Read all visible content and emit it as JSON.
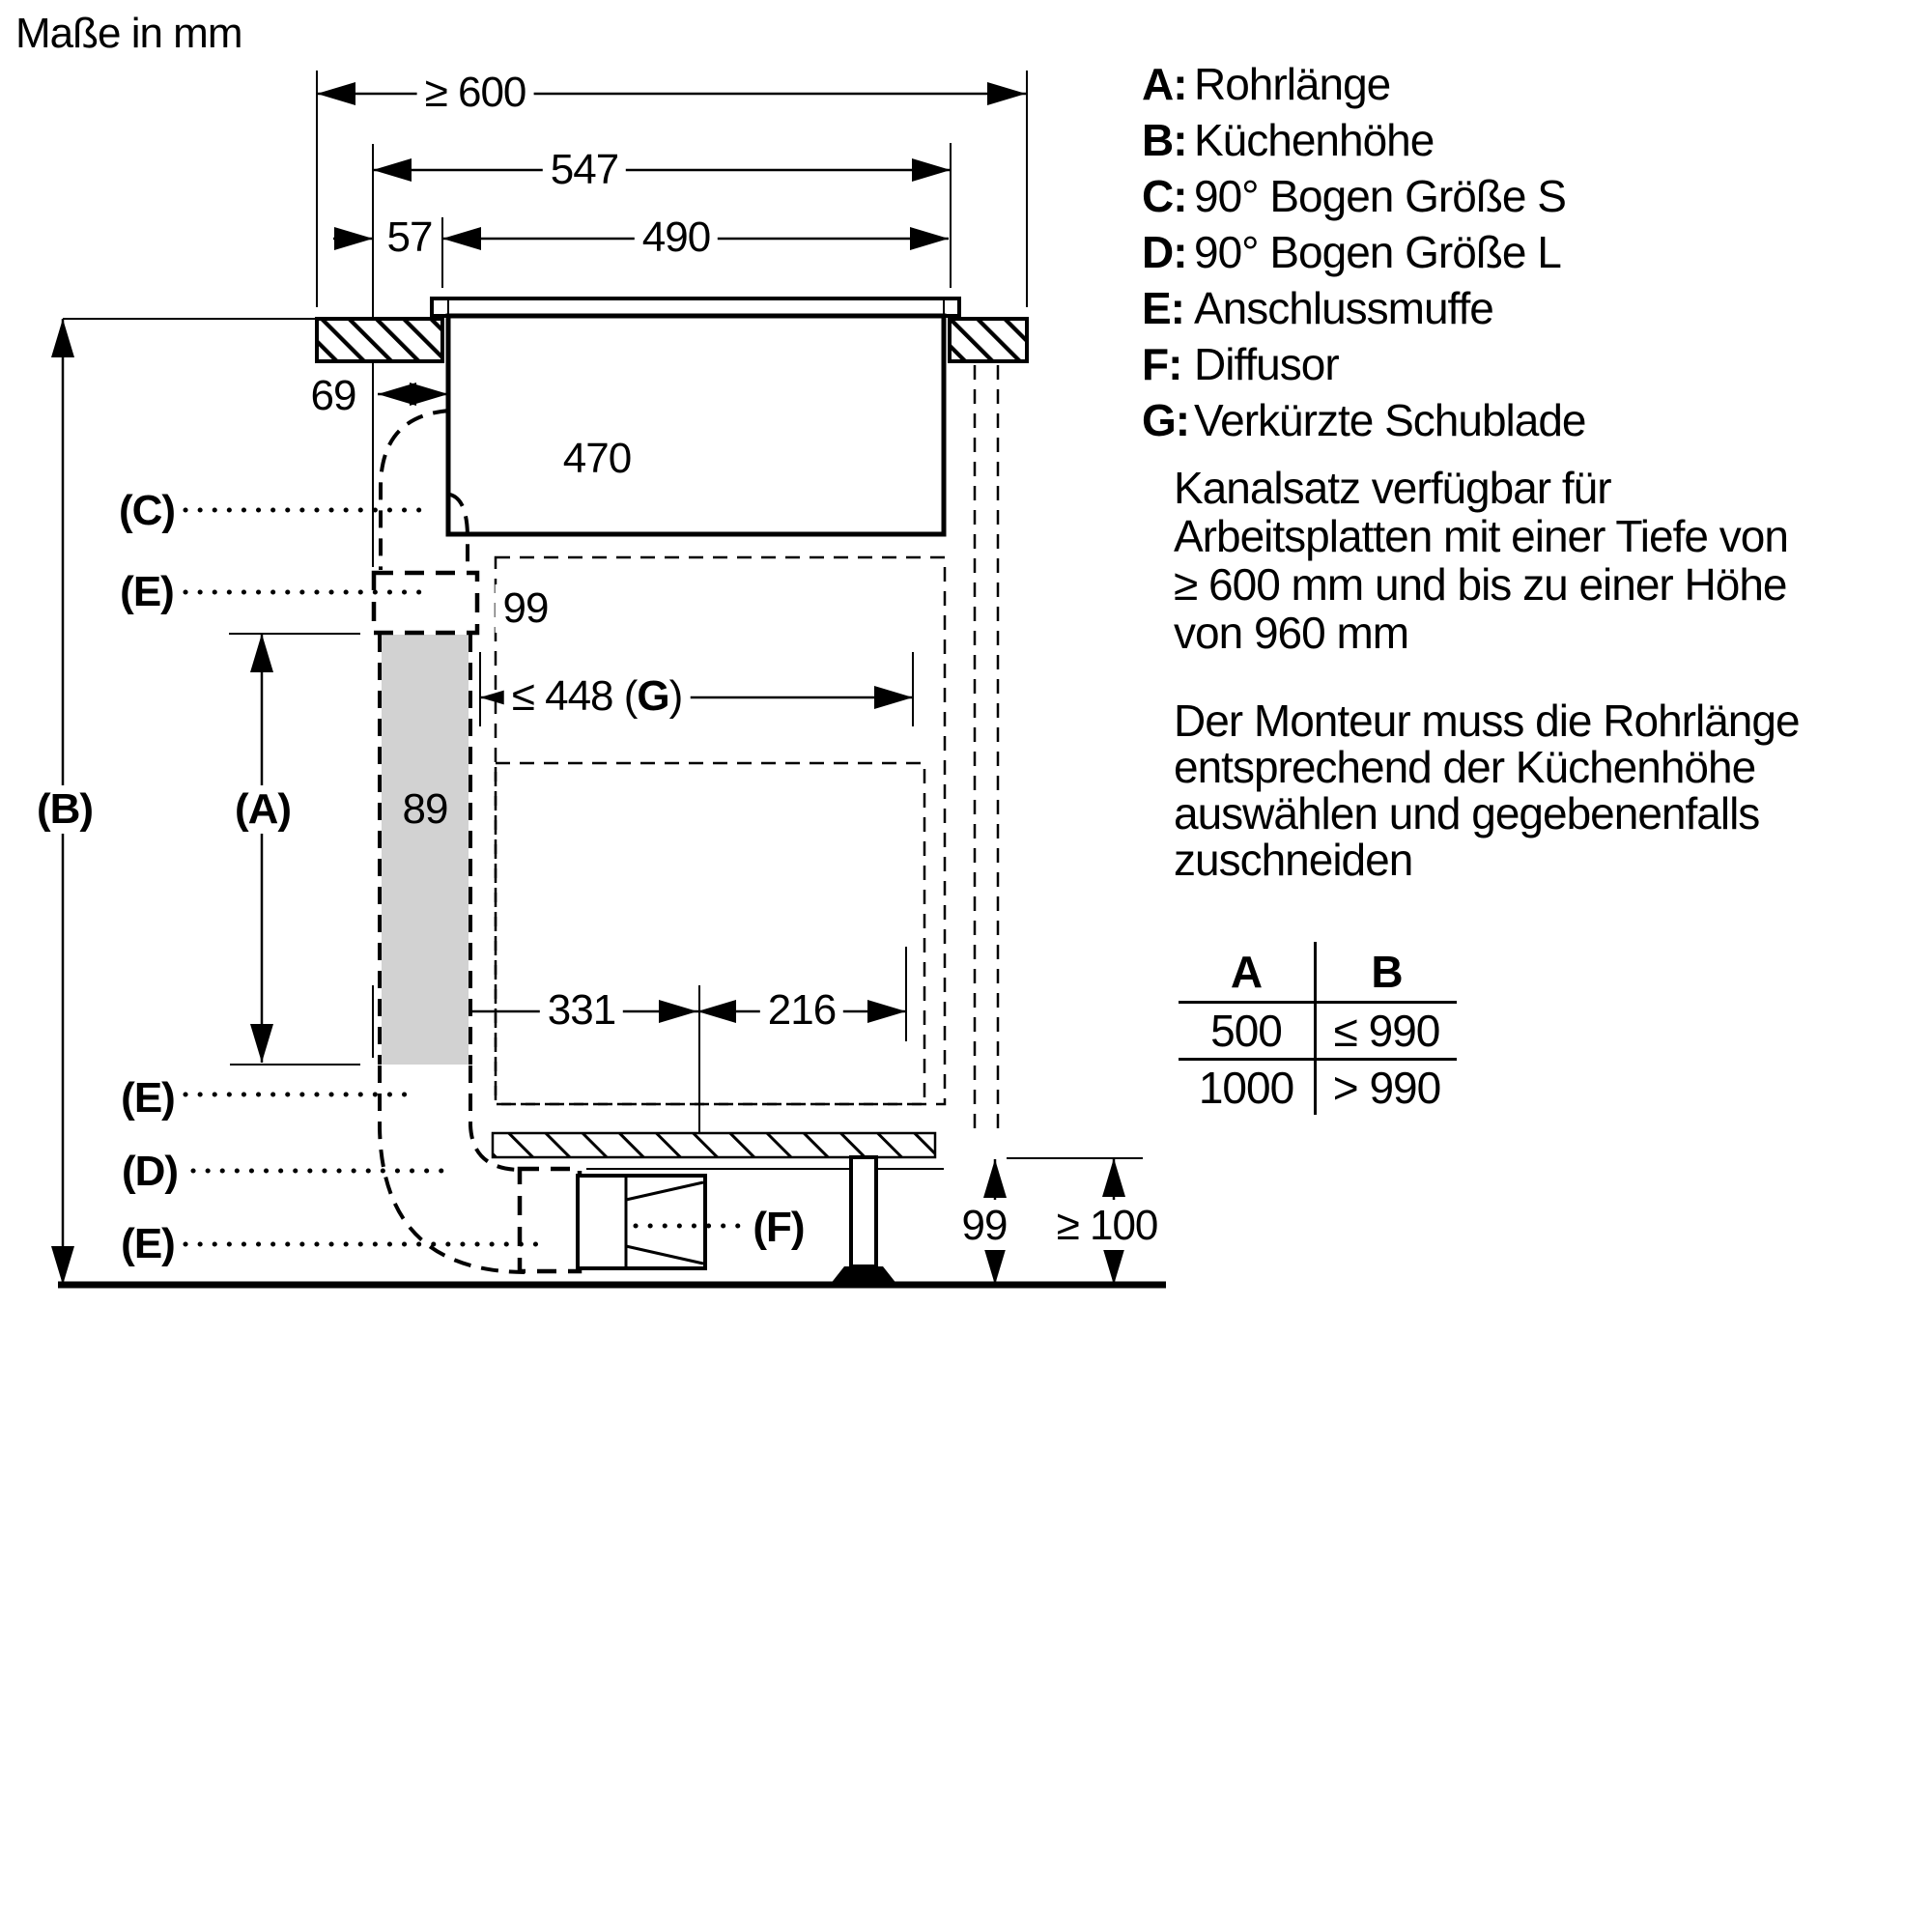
{
  "title": "Maße in mm",
  "colors": {
    "line": "#000000",
    "duct_fill": "#d2d2d2",
    "background": "#ffffff"
  },
  "dimensions": {
    "d600": "≥ 600",
    "d547": "547",
    "d490": "490",
    "d57": "57",
    "d69": "69",
    "d470": "470",
    "d99_connector": "99",
    "d448_prefix": "≤ 448 (",
    "d448_letter": "G",
    "d448_suffix": ")",
    "d89": "89",
    "d331": "331",
    "d216": "216",
    "d99_bottom": "99",
    "d100": "≥ 100"
  },
  "labels": {
    "a": "(A)",
    "b": "(B)",
    "c": "(C)",
    "d": "(D)",
    "e": "(E)",
    "f": "(F)"
  },
  "legend": {
    "items": [
      {
        "key": "A:",
        "text": "Rohrlänge"
      },
      {
        "key": "B:",
        "text": "Küchenhöhe"
      },
      {
        "key": "C:",
        "text": "90° Bogen Größe S"
      },
      {
        "key": "D:",
        "text": "90° Bogen Größe L"
      },
      {
        "key": "E:",
        "text": "Anschlussmuffe"
      },
      {
        "key": "F:",
        "text": "Diffusor"
      },
      {
        "key": "G:",
        "text": "Verkürzte Schublade"
      }
    ]
  },
  "notes": {
    "p1_lines": [
      "Kanalsatz verfügbar für",
      "Arbeitsplatten mit einer Tiefe von",
      "≥ 600 mm und bis zu einer Höhe",
      "von 960 mm"
    ],
    "p2_lines": [
      "Der Monteur muss die Rohrlänge",
      "entsprechend der Küchenhöhe",
      "auswählen und gegebenenfalls",
      "zuschneiden"
    ]
  },
  "table": {
    "header_a": "A",
    "header_b": "B",
    "rows": [
      {
        "a": "500",
        "b": "≤ 990"
      },
      {
        "a": "1000",
        "b": "> 990"
      }
    ]
  }
}
